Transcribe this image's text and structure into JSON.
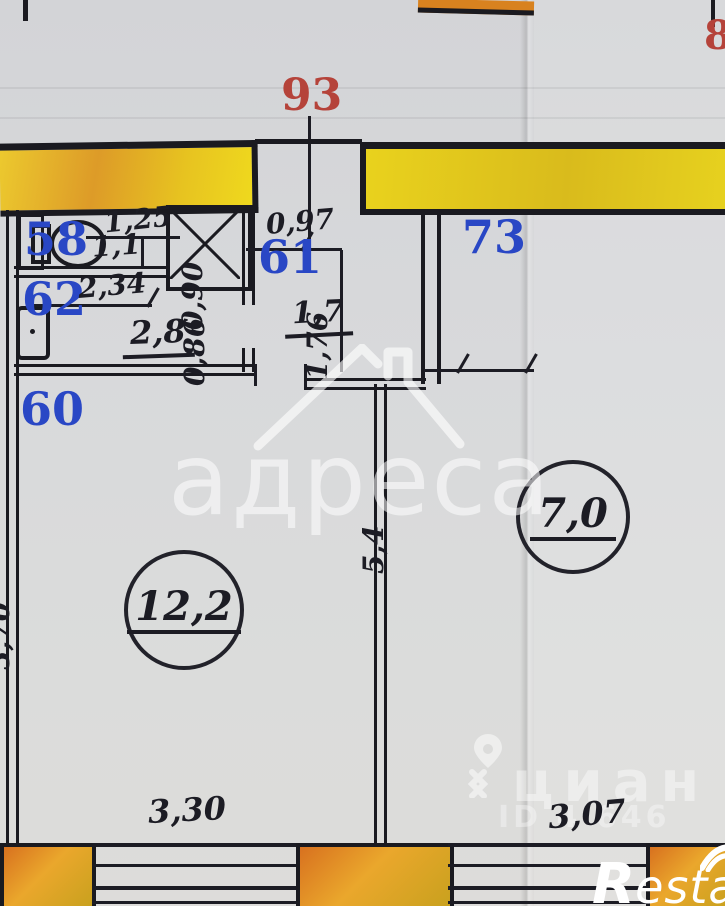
{
  "apartment_numbers": {
    "top": "93",
    "top_right": "8"
  },
  "room_numbers": {
    "r58": "58",
    "r62": "62",
    "r60": "60",
    "r61": "61",
    "r73": "73"
  },
  "dimensions": {
    "d125": "1,25",
    "d11": "1,1",
    "d234": "2,34",
    "d090": "0,90",
    "d097": "0,97",
    "d176": "1,76",
    "d086": "0,86",
    "d370": "3,70",
    "d54": "5,4",
    "d330": "3,30",
    "d307": "3,07"
  },
  "areas": {
    "a28": "2,8",
    "a17": "1,7",
    "a122": "12,2",
    "a70": "7,0"
  },
  "watermarks": {
    "adresa": "адреса",
    "cian": "циан",
    "cian_id": "ID 4 646",
    "restate_r": "R",
    "restate_rest": "estate"
  },
  "colors": {
    "room_number_blue": "#2947c5",
    "apartment_number_red": "#b5433a",
    "wall_yellow": "#e7c320",
    "pier_orange": "#e08627",
    "line_black": "#1a1a20",
    "paper_grey": "#d8d9db"
  }
}
